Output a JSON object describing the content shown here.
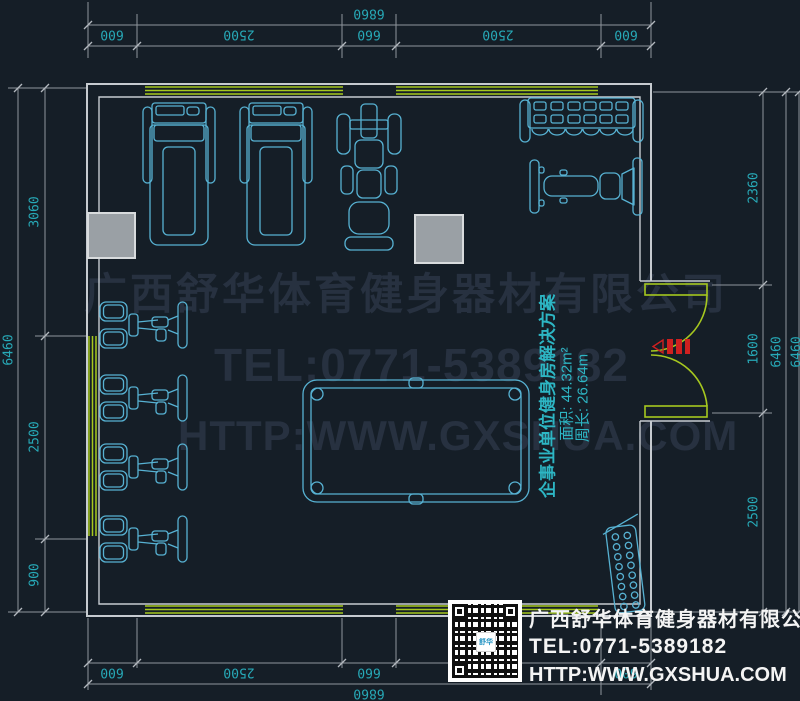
{
  "drawing_type": "gym-floor-plan",
  "dimensions": {
    "top": {
      "overall": "6860",
      "segments": [
        "600",
        "2500",
        "660",
        "2500",
        "600"
      ]
    },
    "bottom": {
      "overall": "6860",
      "segments": [
        "600",
        "2500",
        "660",
        "2500",
        "600"
      ]
    },
    "left": {
      "overall": "6460",
      "segments": [
        "3060",
        "2500",
        "900"
      ]
    },
    "right": {
      "overall": "6460",
      "overall_edge": "6460",
      "segments": [
        "2360",
        "1600",
        "2500"
      ]
    }
  },
  "watermark": {
    "company": "广西舒华体育健身器材有限公司",
    "tel": "TEL:0771-5389182",
    "website": "HTTP:WWW.GXSHUA.COM"
  },
  "plan_info": {
    "title": "企事业单位健身房解决方案",
    "area": "面积: 44.32m²",
    "perimeter": "周长: 26.64m"
  },
  "footer": {
    "company": "广西舒华体育健身器材有限公司",
    "tel": "TEL:0771-5389182",
    "website": "HTTP:WWW.GXSHUA.COM",
    "logo_text": "舒华"
  },
  "colors": {
    "background": "#151e27",
    "equipment_cyan": "#57b2d3",
    "dimension_text_teal": "#27a9b7",
    "wall_grey": "#c6cbd0",
    "window_green": "#a6c81f",
    "door_green": "#a6c81f",
    "dimension_line_grey": "#8f959c",
    "watermark_grey": "#273140",
    "entrance_red": "#cf2020",
    "pillar_grey": "#9aa0a5"
  }
}
